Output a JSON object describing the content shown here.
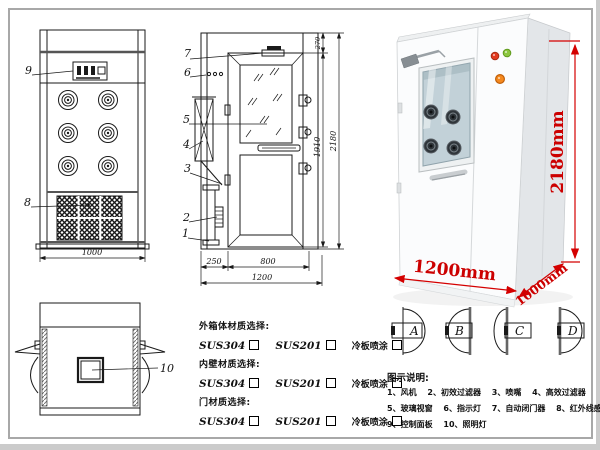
{
  "colors": {
    "dimension_red": "#cc0000",
    "drawing_line": "#1a1a1a"
  },
  "front_view": {
    "callout_control_panel": "9",
    "callout_grille": "8",
    "dim_width": "1000"
  },
  "side_view": {
    "callout_door_closer": "7",
    "callout_indicator": "6",
    "callout_glass": "5",
    "callout_filter": "4",
    "callout_bracket": "3",
    "callout_filter_box": "2",
    "callout_pipe": "1",
    "dim_left": "250",
    "dim_door": "800",
    "dim_total_width": "1200",
    "dim_top": "270",
    "dim_inner_height": "1910",
    "dim_total_height": "2180"
  },
  "top_view": {
    "callout_lamp": "10"
  },
  "photo": {
    "dim_height": "2180mm",
    "dim_width": "1200mm",
    "dim_depth": "1000mm"
  },
  "materials": {
    "sections": [
      {
        "title": "外箱体材质选择:",
        "options": [
          "SUS304",
          "SUS201",
          "冷板喷涂"
        ]
      },
      {
        "title": "内壁材质选择:",
        "options": [
          "SUS304",
          "SUS201",
          "冷板喷涂"
        ]
      },
      {
        "title": "门材质选择:",
        "options": [
          "SUS304",
          "SUS201",
          "冷板喷涂"
        ]
      }
    ]
  },
  "door_types": {
    "labels": [
      "A",
      "B",
      "C",
      "D"
    ]
  },
  "legend": {
    "title": "图示说明:",
    "rows": [
      [
        "1、风机",
        "2、初效过滤器",
        "3、喷嘴",
        "4、高效过滤器"
      ],
      [
        "5、玻璃视窗",
        "6、指示灯",
        "7、自动闭门器",
        "8、红外线感应器"
      ],
      [
        "9、控制面板",
        "10、照明灯"
      ]
    ]
  }
}
